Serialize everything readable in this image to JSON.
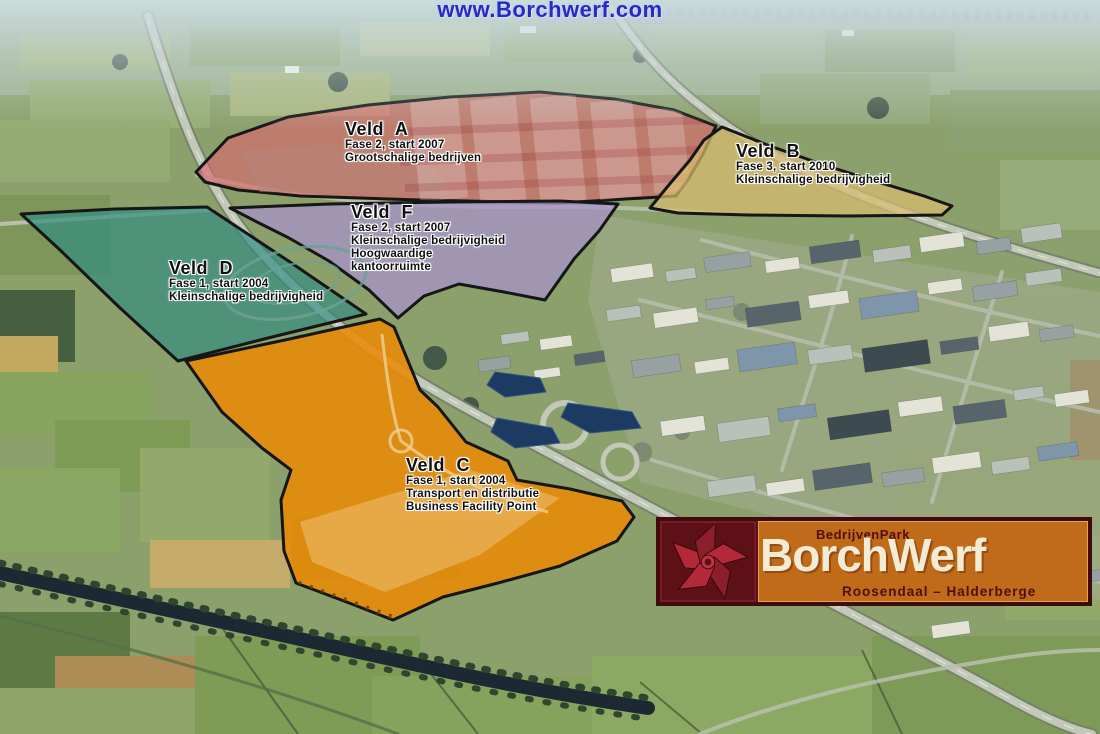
{
  "banner": {
    "url_text": "www.Borchwerf.com",
    "color": "#2828cc"
  },
  "map_title": "BorchWerf business park development map",
  "zones": [
    {
      "id": "A",
      "name": "Veld A",
      "lines": [
        "Fase 2, start 2007",
        "Grootschalige bedrijven"
      ],
      "fill": "#dd6570"
    },
    {
      "id": "B",
      "name": "Veld B",
      "lines": [
        "Fase 3, start 2010",
        "Kleinschalige bedrijvigheid"
      ],
      "fill": "#d8bc6e"
    },
    {
      "id": "F",
      "name": "Veld F",
      "lines": [
        "Fase 2, start 2007",
        "Kleinschalige bedrijvigheid",
        "Hoogwaardige",
        "kantoorruimte"
      ],
      "fill": "#a892cc"
    },
    {
      "id": "D",
      "name": "Veld D",
      "lines": [
        "Fase 1, start 2004",
        "Kleinschalige bedrijvigheid"
      ],
      "fill": "#2f8c80"
    },
    {
      "id": "C",
      "name": "Veld C",
      "lines": [
        "Fase 1, start 2004",
        "Transport en distributie",
        "Business Facility Point"
      ],
      "fill": "#e88a06"
    }
  ],
  "logo": {
    "park_type": "BedrijvenPark",
    "name": "BorchWerf",
    "region": "Roosendaal – Halderberge",
    "panel_color": "#c06b1a",
    "frame_color": "#3f0b0e",
    "text_color": "#f3ecd2",
    "dark_text_color": "#4f0e10",
    "pinwheel_color": "#b3293a"
  }
}
